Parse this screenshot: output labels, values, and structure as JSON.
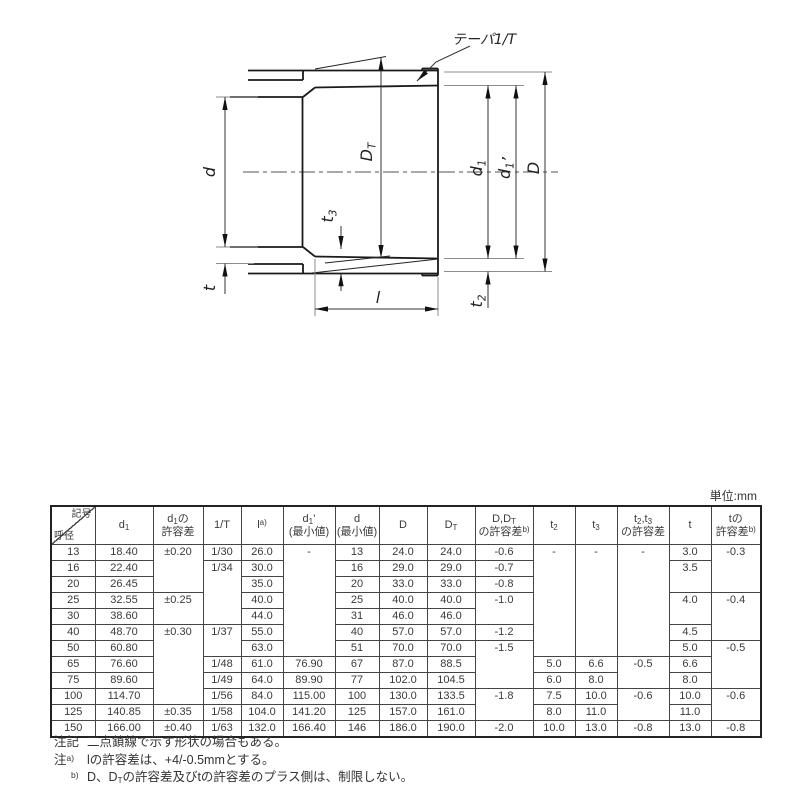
{
  "drawing": {
    "labels": {
      "taper": "テーパ1/T",
      "d": "d",
      "t": "t",
      "DT": "D~T~",
      "t3": "t~3~",
      "l": "l",
      "d1": "d~1~",
      "d1p": "d~1~’",
      "D": "D",
      "t2": "t~2~"
    }
  },
  "table": {
    "unit_label": "単位:mm",
    "header": {
      "corner_top": "記号",
      "corner_bottom": "呼径",
      "cols": [
        "d~1~",
        "d~1~の\n許容差",
        "1/T",
        "l^a)^",
        "d~1~’\n(最小値)",
        "d\n(最小値)",
        "D",
        "D~T~",
        "D,D~T~\nの許容差^b)^",
        "t~2~",
        "t~3~",
        "t~2~,t~3~\nの許容差",
        "t",
        "tの\n許容差^b)^"
      ]
    },
    "rows": [
      [
        "13",
        "18.40",
        {
          "t": "±0.20",
          "rs": 3
        },
        "1/30",
        "26.0",
        {
          "t": "-",
          "rs": 7
        },
        "13",
        "24.0",
        "24.0",
        "-0.6",
        {
          "t": "-",
          "rs": 7
        },
        {
          "t": "-",
          "rs": 7
        },
        {
          "t": "-",
          "rs": 7
        },
        "3.0",
        {
          "t": "-0.3",
          "rs": 3
        }
      ],
      [
        "16",
        "22.40",
        null,
        {
          "t": "1/34",
          "rs": 4
        },
        "30.0",
        null,
        "16",
        "29.0",
        "29.0",
        "-0.7",
        null,
        null,
        null,
        {
          "t": "3.5",
          "rs": 2
        },
        null
      ],
      [
        "20",
        "26.45",
        null,
        null,
        "35.0",
        null,
        "20",
        "33.0",
        "33.0",
        "-0.8",
        null,
        null,
        null,
        null,
        null
      ],
      [
        "25",
        "32.55",
        {
          "t": "±0.25",
          "rs": 2
        },
        null,
        "40.0",
        null,
        "25",
        "40.0",
        "40.0",
        {
          "t": "-1.0",
          "rs": 2
        },
        null,
        null,
        null,
        {
          "t": "4.0",
          "rs": 2
        },
        {
          "t": "-0.4",
          "rs": 3
        }
      ],
      [
        "30",
        "38.60",
        null,
        null,
        "44.0",
        null,
        "31",
        "46.0",
        "46.0",
        null,
        null,
        null,
        null,
        null,
        null
      ],
      [
        "40",
        "48.70",
        {
          "t": "±0.30",
          "rs": 5
        },
        {
          "t": "1/37",
          "rs": 2
        },
        "55.0",
        null,
        "40",
        "57.0",
        "57.0",
        "-1.2",
        null,
        null,
        null,
        "4.5",
        null
      ],
      [
        "50",
        "60.80",
        null,
        null,
        "63.0",
        null,
        "51",
        "70.0",
        "70.0",
        {
          "t": "-1.5",
          "rs": 3
        },
        null,
        null,
        null,
        "5.0",
        {
          "t": "-0.5",
          "rs": 3
        }
      ],
      [
        "65",
        "76.60",
        null,
        "1/48",
        "61.0",
        "76.90",
        "67",
        "87.0",
        "88.5",
        null,
        "5.0",
        "6.6",
        {
          "t": "-0.5",
          "rs": 2
        },
        "6.6",
        null
      ],
      [
        "75",
        "89.60",
        null,
        "1/49",
        "64.0",
        "89.90",
        "77",
        "102.0",
        "104.5",
        null,
        "6.0",
        "8.0",
        null,
        "8.0",
        null
      ],
      [
        "100",
        "114.70",
        null,
        "1/56",
        "84.0",
        "115.00",
        "100",
        "130.0",
        "133.5",
        {
          "t": "-1.8",
          "rs": 2
        },
        "7.5",
        "10.0",
        {
          "t": "-0.6",
          "rs": 2
        },
        "10.0",
        {
          "t": "-0.6",
          "rs": 2
        }
      ],
      [
        "125",
        "140.85",
        "±0.35",
        "1/58",
        "104.0",
        "141.20",
        "125",
        "157.0",
        "161.0",
        null,
        "8.0",
        "11.0",
        null,
        "11.0",
        null
      ],
      [
        "150",
        "166.00",
        "±0.40",
        "1/63",
        "132.0",
        "166.40",
        "146",
        "186.0",
        "190.0",
        "-2.0",
        "10.0",
        "13.0",
        "-0.8",
        "13.0",
        "-0.8"
      ]
    ]
  },
  "notes": [
    {
      "prefix": "注記",
      "text": "二点鎖線で示す形状の場合もある。"
    },
    {
      "prefix": "注^a)^",
      "text": "lの許容差は、+4/-0.5mmとする。"
    },
    {
      "prefix": "^b)^",
      "text": "D、D~T~の許容差及びtの許容差のプラス側は、制限しない。"
    }
  ],
  "colors": {
    "line": "#1a1a1a",
    "dim": "#333333",
    "ext": "#8c8c8c",
    "text": "#333333"
  }
}
